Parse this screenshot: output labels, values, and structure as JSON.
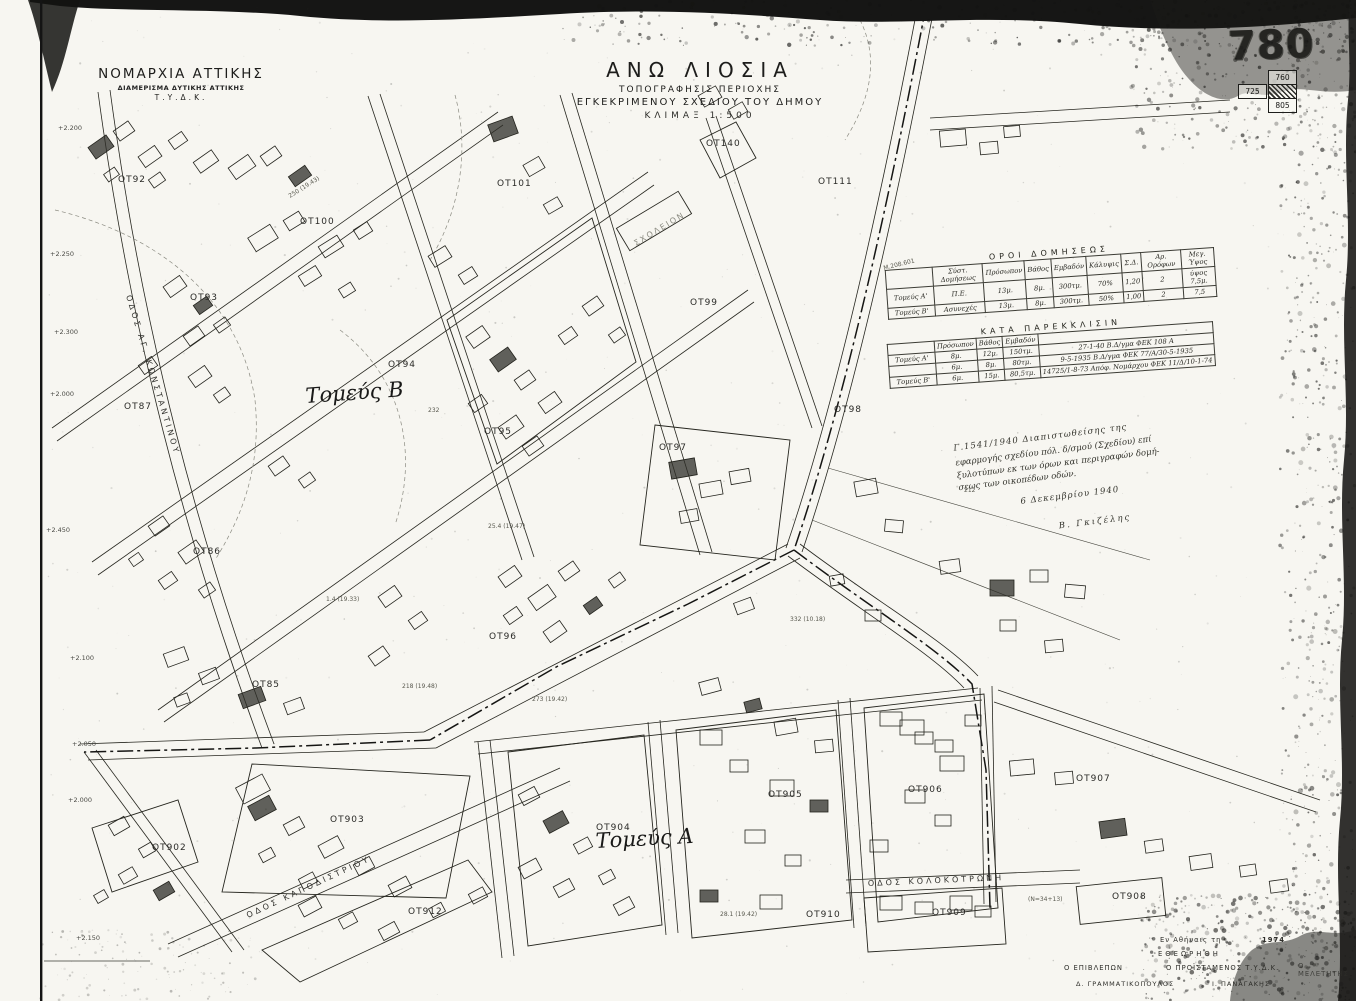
{
  "agency": {
    "line1": "ΝΟΜΑΡΧΙΑ ΑΤΤΙΚΗΣ",
    "line2": "ΔΙΑΜΕΡΙΣΜΑ ΔΥΤΙΚΗΣ ΑΤΤΙΚΗΣ",
    "line3": "Τ.Υ.Δ.Κ."
  },
  "title": {
    "line1": "ΑΝΩ ΛΙΟΣΙΑ",
    "line2": "ΤΟΠΟΓΡΑΦΗΣΙΣ ΠΕΡΙΟΧΗΣ",
    "line3": "ΕΓΚΕΚΡΙΜΕΝΟΥ ΣΧΕΔΙΟΥ ΤΟΥ ΔΗΜΟΥ",
    "line4": "ΚΛΙΜΑΞ 1:500"
  },
  "sheet_index": {
    "number": "780",
    "neighbors": {
      "top": "760",
      "left": "725",
      "bottom": "805"
    }
  },
  "terms_table": {
    "title": "ΟΡΟΙ ΔΟΜΗΣΕΩΣ",
    "columns": [
      "",
      "Σύστ. Δομήσεως",
      "Πρόσωπον",
      "Βάθος",
      "Εμβαδόν",
      "Κάλυψις",
      "Σ.Δ.",
      "Αρ. Ορόφων",
      "Μεγ. Ύψος"
    ],
    "rows": [
      [
        "Τομεύς Α'",
        "Π.Ε.",
        "13μ.",
        "8μ.",
        "300τμ.",
        "70%",
        "1,20",
        "2",
        "ύψος 7,5μ."
      ],
      [
        "Τομεύς Β'",
        "Ασυνεχές",
        "13μ.",
        "8μ.",
        "300τμ.",
        "50%",
        "1,00",
        "2",
        "7,5"
      ]
    ]
  },
  "exception_table": {
    "title": "ΚΑΤΑ ΠΑΡΕΚΚΛΙΣΙΝ",
    "columns": [
      "",
      "Πρόσωπον",
      "Βάθος",
      "Εμβαδόν",
      ""
    ],
    "rows": [
      [
        "Τομεύς Α'",
        "8μ.",
        "12μ.",
        "150τμ.",
        "27-1-40 Β.Δ/γμα ΦΕΚ 108 Α"
      ],
      [
        "",
        "6μ.",
        "8μ.",
        "80τμ.",
        "9-5-1935 Β.Δ/γμα ΦΕΚ 77/Α/30-5-1935"
      ],
      [
        "Τομεύς Β'",
        "6μ.",
        "15μ.",
        "80,5τμ.",
        "14725/1-8-73 Απόφ. Νομάρχου ΦΕΚ 11/Δ/10-1-74"
      ]
    ]
  },
  "note": {
    "lines": [
      "Γ.1541/1940      Διαπιστωθείσης της",
      "εφαρμογής σχεδίου πόλ. δ/σμού (Σχεδίου) επί",
      "ξυλοτύπων εκ των όρων και περιγραφών δομή-",
      "σεως των οικοπέδων οδών."
    ],
    "date": "6 Δεκεμβρίου 1940",
    "signature": "Β. Γκιζέλης"
  },
  "signoff": {
    "place": "Εν Αθήναις τη",
    "year": "1974",
    "reviewed": "ΕΘΕΩΡΗΘΗ",
    "roles": [
      "Ο ΕΠΙΒΛΕΠΩΝ",
      "Ο ΠΡΟΪΣΤΑΜΕΝΟΣ Τ.Υ.Δ.Κ.",
      "Ο ΜΕΛΕΤΗΤΗΣ"
    ],
    "names": [
      "Δ. ΓΡΑΜΜΑΤΙΚΟΠΟΥΛΟΣ",
      "Ι. ΠΑΝΑΓΑΚΗΣ"
    ]
  },
  "map": {
    "sectors": [
      {
        "label": "Τομεύς Β",
        "x": 306,
        "y": 403,
        "rot": -4
      },
      {
        "label": "Τομεύς Α",
        "x": 596,
        "y": 848,
        "rot": -3
      }
    ],
    "blocks": [
      {
        "label": "ΟΤ92",
        "x": 118,
        "y": 182
      },
      {
        "label": "ΟΤ100",
        "x": 300,
        "y": 224
      },
      {
        "label": "ΟΤ101",
        "x": 497,
        "y": 186
      },
      {
        "label": "ΟΤ93",
        "x": 190,
        "y": 300
      },
      {
        "label": "ΟΤ94",
        "x": 388,
        "y": 367
      },
      {
        "label": "ΟΤ140",
        "x": 706,
        "y": 146
      },
      {
        "label": "ΟΤ111",
        "x": 818,
        "y": 184
      },
      {
        "label": "ΟΤ87",
        "x": 124,
        "y": 409
      },
      {
        "label": "ΟΤ99",
        "x": 690,
        "y": 305
      },
      {
        "label": "ΟΤ95",
        "x": 484,
        "y": 434
      },
      {
        "label": "ΟΤ97",
        "x": 659,
        "y": 450
      },
      {
        "label": "ΟΤ98",
        "x": 834,
        "y": 412
      },
      {
        "label": "ΟΤ86",
        "x": 193,
        "y": 554
      },
      {
        "label": "ΟΤ96",
        "x": 489,
        "y": 639
      },
      {
        "label": "ΟΤ85",
        "x": 252,
        "y": 687
      },
      {
        "label": "ΟΤ902",
        "x": 152,
        "y": 850
      },
      {
        "label": "ΟΤ903",
        "x": 330,
        "y": 822
      },
      {
        "label": "ΟΤ904",
        "x": 596,
        "y": 830
      },
      {
        "label": "ΟΤ905",
        "x": 768,
        "y": 797
      },
      {
        "label": "ΟΤ906",
        "x": 908,
        "y": 792
      },
      {
        "label": "ΟΤ907",
        "x": 1076,
        "y": 781
      },
      {
        "label": "ΟΤ908",
        "x": 1112,
        "y": 899
      },
      {
        "label": "ΟΤ909",
        "x": 932,
        "y": 915
      },
      {
        "label": "ΟΤ910",
        "x": 806,
        "y": 917
      },
      {
        "label": "ΟΤ912",
        "x": 408,
        "y": 914
      }
    ],
    "streets": [
      {
        "name": "ΟΔΟΣ ΑΓ. ΚΩΝΣΤΑΝΤΙΝΟΥ",
        "x": 126,
        "y": 296,
        "rot": 73
      },
      {
        "name": "ΟΔΟΣ ΚΑΠΟΔΙΣΤΡΙΟΥ",
        "x": 248,
        "y": 918,
        "rot": -25
      },
      {
        "name": "ΟΔΟΣ ΚΟΛΟΚΟΤΡΩΝΗ",
        "x": 868,
        "y": 886,
        "rot": -2.5
      }
    ],
    "poi": [
      {
        "label": "ΣΧΟΛΕΙΟΝ",
        "x": 636,
        "y": 246,
        "rot": -31
      }
    ],
    "elevations": [
      {
        "v": "+2.200",
        "x": 58,
        "y": 130
      },
      {
        "v": "+2.250",
        "x": 50,
        "y": 256
      },
      {
        "v": "+2.300",
        "x": 54,
        "y": 334
      },
      {
        "v": "+2.000",
        "x": 50,
        "y": 396
      },
      {
        "v": "+2.450",
        "x": 46,
        "y": 532
      },
      {
        "v": "+2.100",
        "x": 70,
        "y": 660
      },
      {
        "v": "+2.050",
        "x": 72,
        "y": 746
      },
      {
        "v": "+2.000",
        "x": 68,
        "y": 802
      },
      {
        "v": "+2.150",
        "x": 76,
        "y": 940
      }
    ],
    "measurements": [
      {
        "text": "250 (19.43)",
        "x": 290,
        "y": 198,
        "rot": -32
      },
      {
        "text": "232",
        "x": 428,
        "y": 412,
        "rot": 0
      },
      {
        "text": "25.4 (19.47)",
        "x": 488,
        "y": 528,
        "rot": 0
      },
      {
        "text": "1.4 (19.33)",
        "x": 326,
        "y": 601,
        "rot": 0
      },
      {
        "text": "218 (19.48)",
        "x": 402,
        "y": 688,
        "rot": 0
      },
      {
        "text": "273 (19.42)",
        "x": 532,
        "y": 701,
        "rot": 0
      },
      {
        "text": "28.1 (19.42)",
        "x": 720,
        "y": 916,
        "rot": 0
      },
      {
        "text": "Μ.208.601",
        "x": 884,
        "y": 270,
        "rot": -14
      },
      {
        "text": "332 (10.18)",
        "x": 790,
        "y": 621,
        "rot": 0
      },
      {
        "text": "212",
        "x": 964,
        "y": 492,
        "rot": 0
      },
      {
        "text": "(Ν=34+13)",
        "x": 1028,
        "y": 901,
        "rot": 0
      }
    ]
  }
}
